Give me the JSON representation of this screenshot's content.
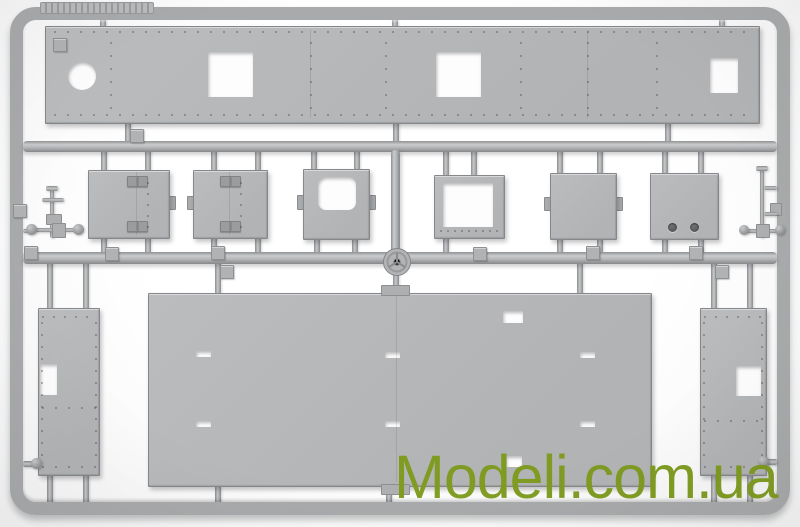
{
  "scene": {
    "subject": "Gray injection-molded plastic model-kit sprue with flat riveted hull panels and hatches, photographed on a white background",
    "background_color": "#f5f5f6",
    "plastic_color": "#b4b6b8",
    "plastic_dark_color": "#8b8d8f",
    "plastic_light_color": "#cfd1d3",
    "frame_color": "#a8aaac"
  },
  "watermark": {
    "text": "Modeli.com.ua",
    "color": "#7e9b1e"
  }
}
